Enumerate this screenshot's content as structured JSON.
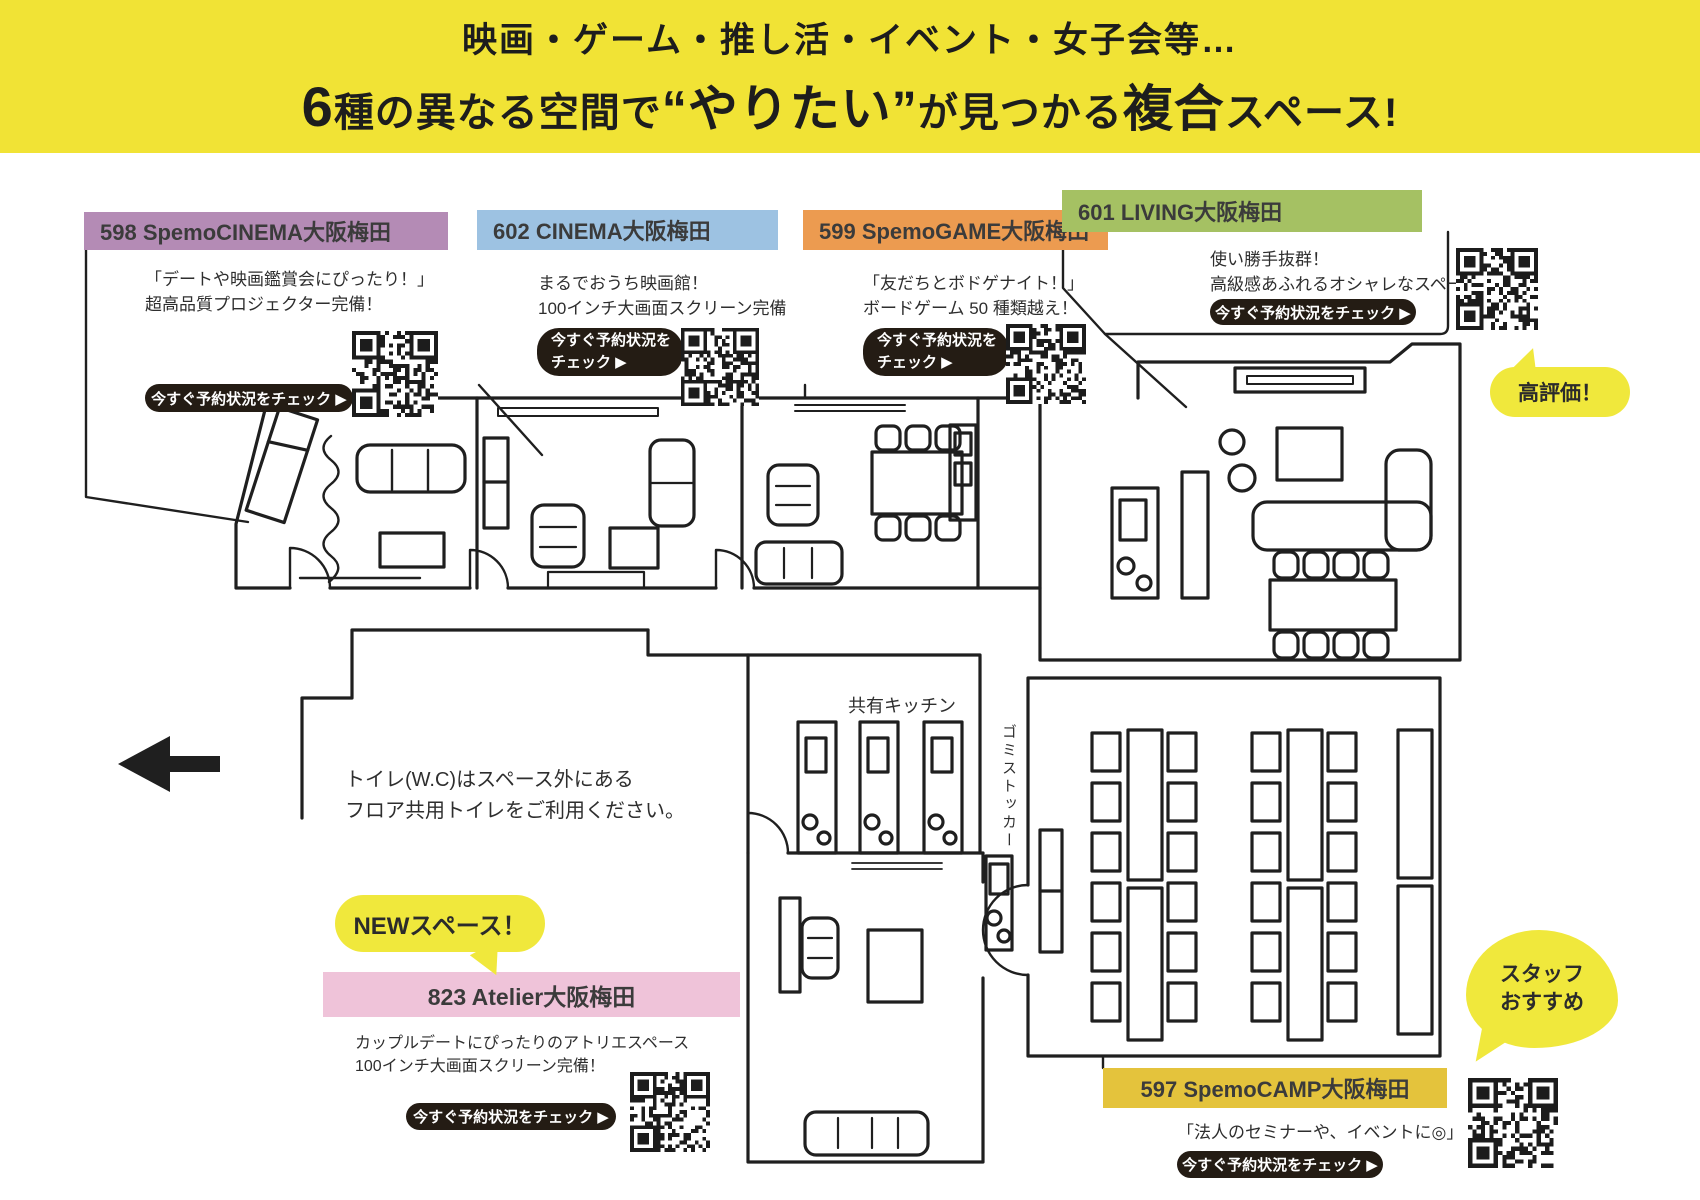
{
  "banner": {
    "line1": "映画・ゲーム・推し活・イベント・女子会等…",
    "seg_6": "6",
    "seg_a": "種の異なる空間で",
    "seg_b": "“やりたい”",
    "seg_c": "が見つかる",
    "seg_d": "複合",
    "seg_e": "スペース!"
  },
  "spaces": [
    {
      "title": "598 SpemoCINEMA大阪梅田",
      "desc1": "「デートや映画鑑賞会にぴったり！」",
      "desc2": "超高品質プロジェクター完備！",
      "button": "今すぐ予約状況をチェック ▶",
      "header_color": "#b48bb5"
    },
    {
      "title": "602 CINEMA大阪梅田",
      "desc1": "まるでおうち映画館！",
      "desc2": "100インチ大画面スクリーン完備",
      "button_line1": "今すぐ予約状況を",
      "button_line2": "チェック ▶",
      "header_color": "#9dc2e2"
    },
    {
      "title": "599 SpemoGAME大阪梅田",
      "desc1": "「友だちとボドゲナイト！」",
      "desc2": "ボードゲーム 50 種類越え！",
      "button_line1": "今すぐ予約状況を",
      "button_line2": "チェック ▶",
      "header_color": "#ec9b50"
    },
    {
      "title": "601 LIVING大阪梅田",
      "desc1": "使い勝手抜群！",
      "desc2": "高級感あふれるオシャレなスペース",
      "button": "今すぐ予約状況をチェック ▶",
      "header_color": "#a5c163"
    },
    {
      "title": "823  Atelier大阪梅田",
      "desc1": "カップルデートにぴったりのアトリエスペース",
      "desc2": "100インチ大画面スクリーン完備！",
      "button": "今すぐ予約状況をチェック ▶",
      "header_color": "#efc3d9"
    },
    {
      "title": "597 SpemoCAMP大阪梅田",
      "desc1": "「法人のセミナーや、イベントに◎」",
      "button": "今すぐ予約状況をチェック ▶",
      "header_color": "#e4c33c"
    }
  ],
  "bubbles": {
    "high_rating": "高評価！",
    "new_space": "NEWスペース！",
    "staff_line1": "スタッフ",
    "staff_line2": "おすすめ"
  },
  "floor_labels": {
    "kitchen": "共有キッチン",
    "trash": "ゴミストッカー",
    "toilet_line1": "トイレ(W.C)はスペース外にある",
    "toilet_line2": "フロア共用トイレをご利用ください。"
  },
  "colors": {
    "banner_bg": "#f1e335",
    "bubble_yellow": "#f0e83c",
    "button_bg": "#241c14",
    "wall_ink": "#1f1f1f"
  }
}
